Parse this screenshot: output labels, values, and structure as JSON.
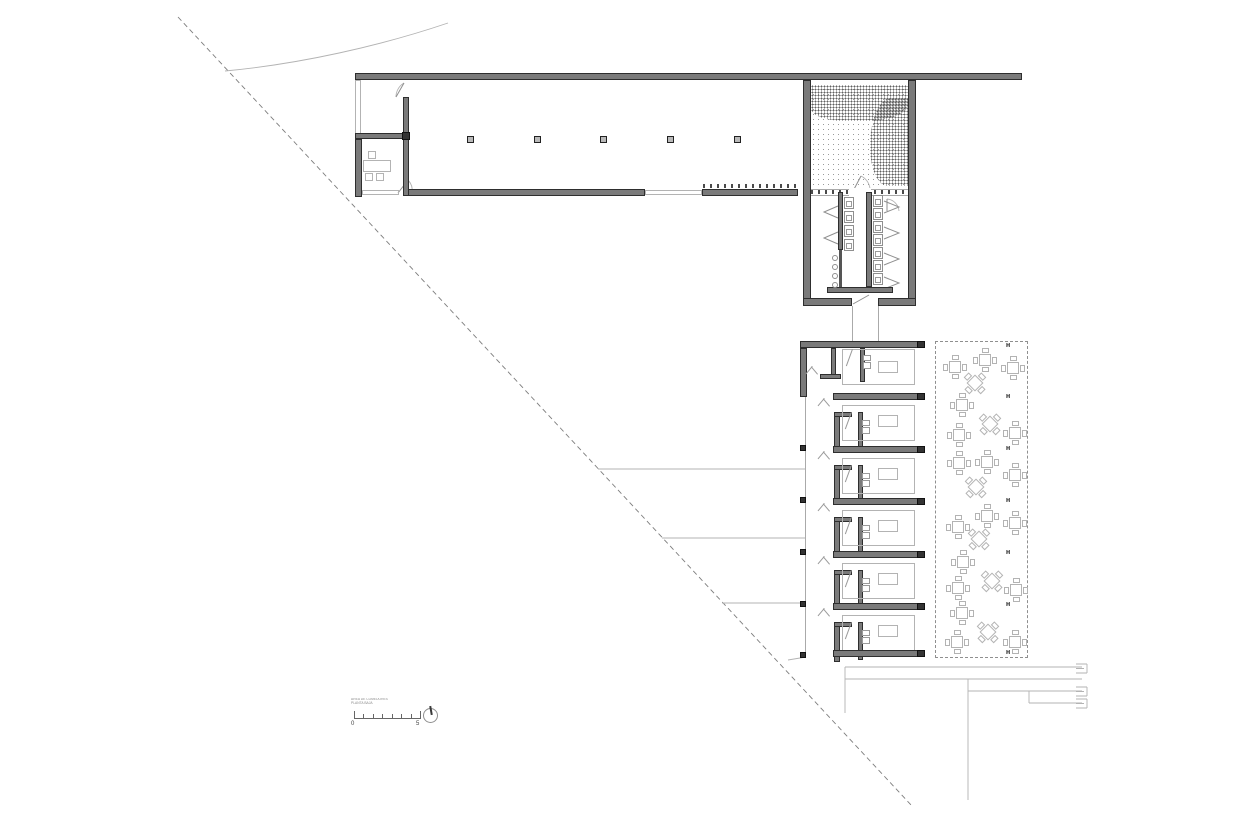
{
  "drawing": {
    "kind": "architectural floor plan, ground floor of an L-shaped building with dormitory rooms, sanitary block, patio with tree and outdoor dining area"
  },
  "scale_bar": {
    "zero_label": "0",
    "five_label": "5",
    "caption_line1": "AREA DE COMEDORES",
    "caption_line2": "PLANTA BAJA",
    "tick_count": 8
  },
  "hall": {
    "columns_x": [
      470,
      537,
      603,
      670,
      737
    ],
    "columns_y": 140
  },
  "walkway": {
    "column_x": 800,
    "columns_y": [
      445,
      497,
      549,
      601,
      652
    ]
  },
  "rooms": {
    "count": 6,
    "module_tops": [
      341,
      393,
      446,
      498,
      551,
      603
    ],
    "bottom_bar_y": 650,
    "cap_x": 917
  },
  "bathrooms": {
    "left_toilets_y": [
      197,
      211,
      225,
      239
    ],
    "right_toilets_y": [
      195,
      208,
      221,
      234,
      247,
      260,
      273
    ],
    "urinals_y": [
      255,
      264,
      273,
      282
    ]
  },
  "dining": {
    "h_marker": "H",
    "h_marker_x": 1006,
    "h_marker_y": [
      343,
      394,
      446,
      498,
      550,
      602,
      650
    ],
    "tables": [
      {
        "x": 955,
        "y": 367,
        "shape": "square"
      },
      {
        "x": 985,
        "y": 360,
        "shape": "square"
      },
      {
        "x": 1013,
        "y": 368,
        "shape": "square"
      },
      {
        "x": 975,
        "y": 383,
        "shape": "diamond"
      },
      {
        "x": 962,
        "y": 405,
        "shape": "square"
      },
      {
        "x": 990,
        "y": 424,
        "shape": "diamond"
      },
      {
        "x": 959,
        "y": 435,
        "shape": "square"
      },
      {
        "x": 1015,
        "y": 433,
        "shape": "square"
      },
      {
        "x": 959,
        "y": 463,
        "shape": "square"
      },
      {
        "x": 987,
        "y": 462,
        "shape": "square"
      },
      {
        "x": 1015,
        "y": 475,
        "shape": "square"
      },
      {
        "x": 976,
        "y": 487,
        "shape": "diamond"
      },
      {
        "x": 987,
        "y": 516,
        "shape": "square"
      },
      {
        "x": 958,
        "y": 527,
        "shape": "square"
      },
      {
        "x": 1015,
        "y": 523,
        "shape": "square"
      },
      {
        "x": 979,
        "y": 539,
        "shape": "diamond"
      },
      {
        "x": 963,
        "y": 562,
        "shape": "square"
      },
      {
        "x": 992,
        "y": 581,
        "shape": "diamond"
      },
      {
        "x": 958,
        "y": 588,
        "shape": "square"
      },
      {
        "x": 1016,
        "y": 590,
        "shape": "square"
      },
      {
        "x": 962,
        "y": 613,
        "shape": "square"
      },
      {
        "x": 988,
        "y": 632,
        "shape": "diamond"
      },
      {
        "x": 957,
        "y": 642,
        "shape": "square"
      },
      {
        "x": 1015,
        "y": 642,
        "shape": "square"
      }
    ]
  },
  "colors": {
    "wall_fill": "#7a7a7a",
    "wall_edge": "#2e2e2e",
    "thin_line": "#b3b3b3",
    "dashed_line": "#7d7d7d",
    "background": "#ffffff"
  }
}
